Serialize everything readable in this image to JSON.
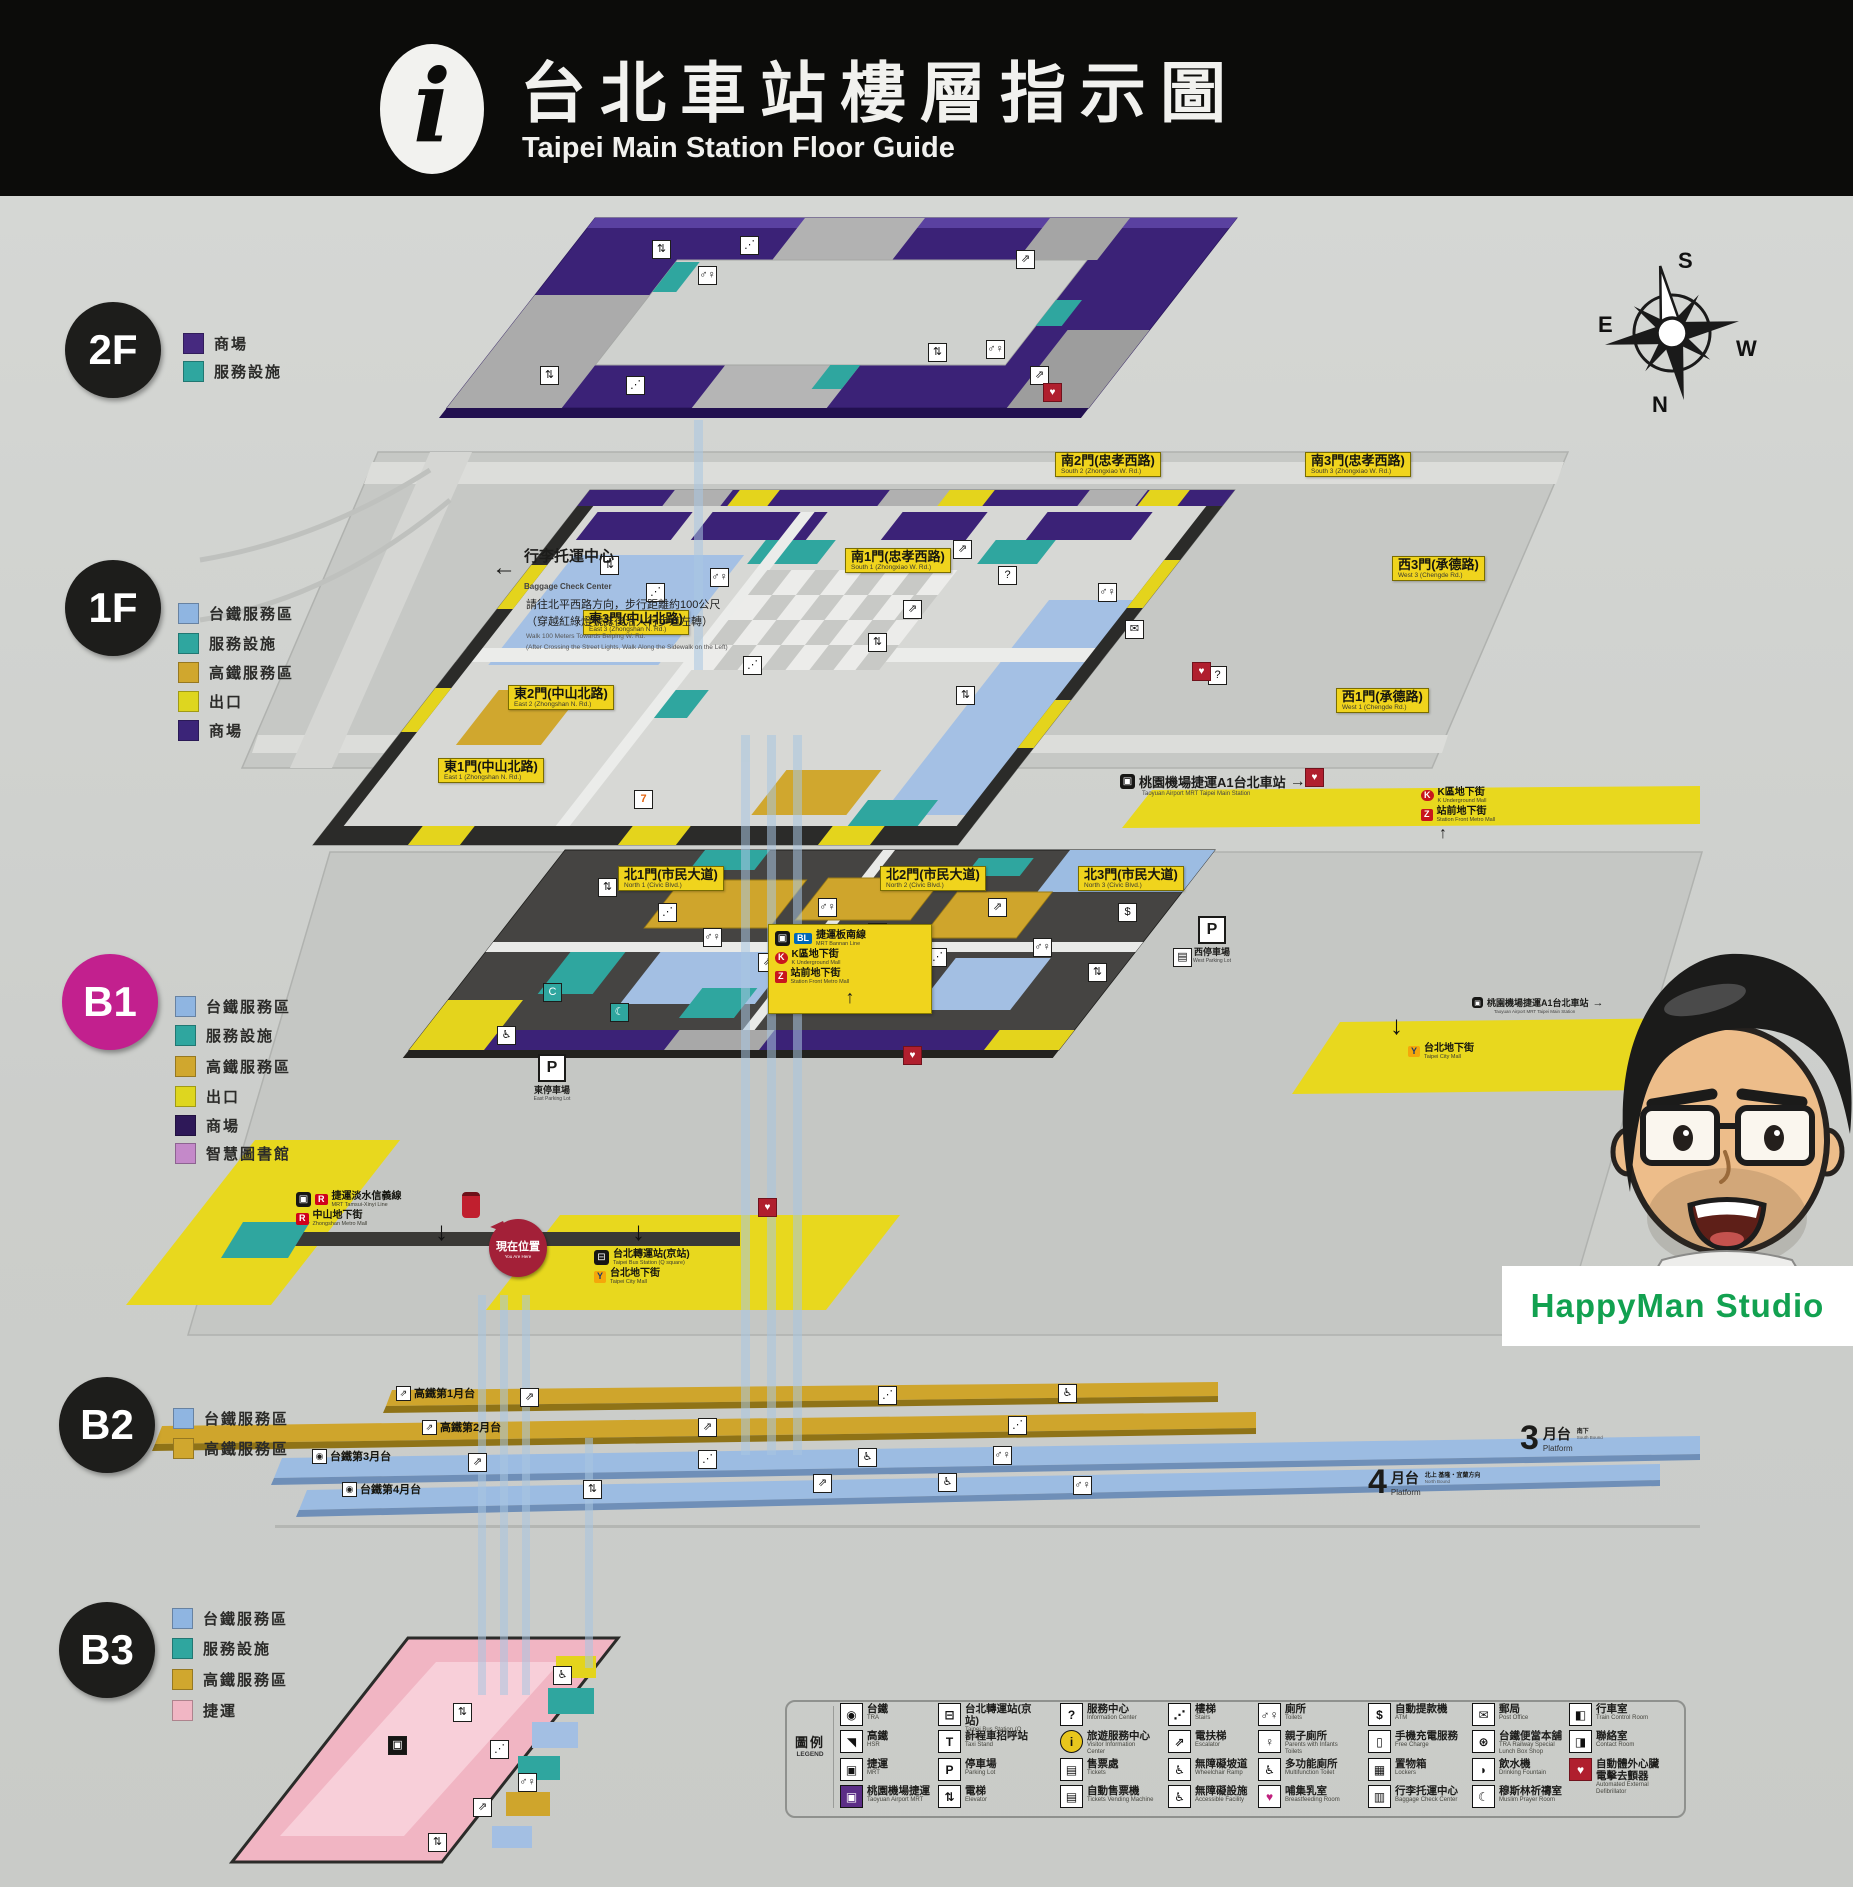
{
  "header": {
    "info_icon": "i",
    "title_cn": "台北車站樓層指示圖",
    "title_en": "Taipei Main Station Floor Guide"
  },
  "compass": {
    "s": "S",
    "e": "E",
    "w": "W",
    "n": "N"
  },
  "colors": {
    "panel_bg": "#d0d2cf",
    "header_bg": "#0c0c0a",
    "mall_purple": "#3b2277",
    "service_teal": "#2fa69f",
    "tra_blue": "#8fb5e1",
    "hsr_mustard": "#d0a72e",
    "exit_yellow": "#f0d41d",
    "library_orchid": "#c489c9",
    "mrt_pink": "#f1b6c4",
    "b1_magenta": "#c2208e",
    "here_red": "#a32038",
    "watermark_green": "#12a150"
  },
  "floor_circles": [
    {
      "label": "2F",
      "x": 113,
      "y": 350,
      "color": "#1d1d1b"
    },
    {
      "label": "1F",
      "x": 113,
      "y": 608,
      "color": "#1d1d1b"
    },
    {
      "label": "B1",
      "x": 110,
      "y": 1002,
      "color": "#c2208e"
    },
    {
      "label": "B2",
      "x": 107,
      "y": 1425,
      "color": "#1d1d1b"
    },
    {
      "label": "B3",
      "x": 107,
      "y": 1650,
      "color": "#1d1d1b"
    }
  ],
  "floor_legends": [
    {
      "x": 183,
      "y": 333,
      "color": "#46297f",
      "label": "商場"
    },
    {
      "x": 183,
      "y": 361,
      "color": "#2fa69f",
      "label": "服務設施"
    },
    {
      "x": 178,
      "y": 603,
      "color": "#8fb5e1",
      "label": "台鐵服務區"
    },
    {
      "x": 178,
      "y": 633,
      "color": "#2fa69f",
      "label": "服務設施"
    },
    {
      "x": 178,
      "y": 662,
      "color": "#d0a72e",
      "label": "高鐵服務區"
    },
    {
      "x": 178,
      "y": 691,
      "color": "#ded61f",
      "label": "出口"
    },
    {
      "x": 178,
      "y": 720,
      "color": "#3b2478",
      "label": "商場"
    },
    {
      "x": 175,
      "y": 996,
      "color": "#8fb5e1",
      "label": "台鐵服務區"
    },
    {
      "x": 175,
      "y": 1025,
      "color": "#2fa69f",
      "label": "服務設施"
    },
    {
      "x": 175,
      "y": 1056,
      "color": "#d0a72e",
      "label": "高鐵服務區"
    },
    {
      "x": 175,
      "y": 1086,
      "color": "#ded61f",
      "label": "出口"
    },
    {
      "x": 175,
      "y": 1115,
      "color": "#2e1858",
      "label": "商場"
    },
    {
      "x": 175,
      "y": 1143,
      "color": "#c489c9",
      "label": "智慧圖書館"
    },
    {
      "x": 173,
      "y": 1408,
      "color": "#8fb5e1",
      "label": "台鐵服務區"
    },
    {
      "x": 173,
      "y": 1438,
      "color": "#d0a72e",
      "label": "高鐵服務區"
    },
    {
      "x": 172,
      "y": 1608,
      "color": "#8fb5e1",
      "label": "台鐵服務區"
    },
    {
      "x": 172,
      "y": 1638,
      "color": "#2fa69f",
      "label": "服務設施"
    },
    {
      "x": 172,
      "y": 1669,
      "color": "#d0a72e",
      "label": "高鐵服務區"
    },
    {
      "x": 172,
      "y": 1700,
      "color": "#f1b6c4",
      "label": "捷運"
    }
  ],
  "gates": [
    {
      "x": 845,
      "y": 548,
      "cn": "南1門(忠孝西路)",
      "en": "South 1 (Zhongxiao W. Rd.)"
    },
    {
      "x": 1055,
      "y": 452,
      "cn": "南2門(忠孝西路)",
      "en": "South 2 (Zhongxiao W. Rd.)"
    },
    {
      "x": 1305,
      "y": 452,
      "cn": "南3門(忠孝西路)",
      "en": "South 3 (Zhongxiao W. Rd.)"
    },
    {
      "x": 583,
      "y": 610,
      "cn": "東3門(中山北路)",
      "en": "East 3 (Zhongshan N. Rd.)"
    },
    {
      "x": 508,
      "y": 685,
      "cn": "東2門(中山北路)",
      "en": "East 2 (Zhongshan N. Rd.)"
    },
    {
      "x": 438,
      "y": 758,
      "cn": "東1門(中山北路)",
      "en": "East 1 (Zhongshan N. Rd.)"
    },
    {
      "x": 1392,
      "y": 556,
      "cn": "西3門(承德路)",
      "en": "West 3 (Chengde Rd.)"
    },
    {
      "x": 1336,
      "y": 688,
      "cn": "西1門(承德路)",
      "en": "West 1 (Chengde Rd.)"
    },
    {
      "x": 618,
      "y": 866,
      "cn": "北1門(市民大道)",
      "en": "North 1 (Civic Blvd.)"
    },
    {
      "x": 880,
      "y": 866,
      "cn": "北2門(市民大道)",
      "en": "North 2 (Civic Blvd.)"
    },
    {
      "x": 1078,
      "y": 866,
      "cn": "北3門(市民大道)",
      "en": "North 3 (Civic Blvd.)"
    }
  ],
  "baggage_note": {
    "arrow": "←",
    "cn": "行李托運中心",
    "en": "Baggage Check Center",
    "body1": "請往北平西路方向，步行距離約100公尺",
    "body2": "（穿越紅綠燈號誌後沿人行步道左轉）",
    "en1": "Walk 100 Meters Towards Beiping W. Rd.",
    "en2": "(After Crossing the Street Lights, Walk Along the Sidewalk on the Left)"
  },
  "a1_sign": {
    "cn": "桃園機場捷運A1台北車站",
    "en": "Taoyuan Airport MRT Taipei Main Station",
    "arrow": "→"
  },
  "b1_badges": {
    "bl": {
      "logo": "BL",
      "cn": "捷運板南線",
      "en": "MRT Bannan Line"
    },
    "k": {
      "logo": "K",
      "cn": "K區地下街",
      "en": "K Underground Mall"
    },
    "z": {
      "logo": "Z",
      "cn": "站前地下街",
      "en": "Station Front Metro Mall"
    },
    "r1": {
      "logo": "R",
      "cn": "捷運淡水信義線",
      "en": "MRT Tamsui-Xinyi Line"
    },
    "r2": {
      "logo": "R",
      "cn": "中山地下街",
      "en": "Zhongshan Metro Mall"
    },
    "bus": {
      "cn": "台北轉運站(京站)",
      "en": "Taipei Bus Station (Q square)"
    },
    "y1": {
      "logo": "Y",
      "cn": "台北地下街",
      "en": "Taipei City Mall"
    },
    "east_p": {
      "logo": "P",
      "cn": "東停車場",
      "en": "East Parking Lot"
    },
    "west_p": {
      "logo": "P",
      "cn": "西停車場",
      "en": "West Parking Lot"
    },
    "here": {
      "cn": "現在位置",
      "en": "You Are Here"
    }
  },
  "plat_labels": [
    {
      "x": 396,
      "y": 1385,
      "ic": "⇗",
      "cn": "高鐵第1月台"
    },
    {
      "x": 422,
      "y": 1419,
      "ic": "⇗",
      "cn": "高鐵第2月台"
    },
    {
      "x": 312,
      "y": 1448,
      "ic": "◉",
      "cn": "台鐵第3月台"
    },
    {
      "x": 342,
      "y": 1481,
      "ic": "◉",
      "cn": "台鐵第4月台"
    }
  ],
  "platforms": {
    "big3": {
      "no": "3",
      "suffix": "月台",
      "en": "Platform",
      "note_cn": "南下",
      "note_en": "South Bound"
    },
    "big4": {
      "no": "4",
      "suffix": "月台",
      "en": "Platform",
      "note_cn": "北上 基隆・宜蘭方向",
      "note_en": "North Bound"
    }
  },
  "icons": {
    "train": "▣",
    "bus": "⊟",
    "arrow_up": "↑",
    "arrow_down": "↓",
    "arrow_right": "→"
  },
  "legend": {
    "title_cn": "圖例",
    "title_en": "LEGEND",
    "items": [
      {
        "x": 840,
        "y": 1703,
        "g": "◉",
        "cn": "台鐵",
        "en": "TRA"
      },
      {
        "x": 840,
        "y": 1730,
        "g": "◥",
        "cn": "高鐵",
        "en": "HSR"
      },
      {
        "x": 840,
        "y": 1758,
        "g": "▣",
        "cn": "捷運",
        "en": "MRT"
      },
      {
        "x": 840,
        "y": 1785,
        "g": "▣",
        "cls": "pur",
        "cn": "桃園機場捷運",
        "en": "Taoyuan Airport MRT"
      },
      {
        "x": 938,
        "y": 1703,
        "g": "⊟",
        "cn": "台北轉運站(京站)",
        "en": "Taipei Bus Station (Q square)"
      },
      {
        "x": 938,
        "y": 1730,
        "g": "T",
        "cn": "計程車招呼站",
        "en": "Taxi Stand"
      },
      {
        "x": 938,
        "y": 1758,
        "g": "P",
        "cn": "停車場",
        "en": "Parking Lot"
      },
      {
        "x": 938,
        "y": 1785,
        "g": "⇅",
        "cn": "電梯",
        "en": "Elevator"
      },
      {
        "x": 1060,
        "y": 1703,
        "g": "?",
        "cn": "服務中心",
        "en": "Information Center"
      },
      {
        "x": 1060,
        "y": 1730,
        "g": "i",
        "cls": "gold",
        "cn": "旅遊服務中心",
        "en": "Visitor Information Center"
      },
      {
        "x": 1060,
        "y": 1758,
        "g": "▤",
        "cn": "售票處",
        "en": "Tickets"
      },
      {
        "x": 1060,
        "y": 1785,
        "g": "▤",
        "cn": "自動售票機",
        "en": "Tickets Vending Machine"
      },
      {
        "x": 1168,
        "y": 1703,
        "g": "⋰",
        "cn": "樓梯",
        "en": "Stairs"
      },
      {
        "x": 1168,
        "y": 1730,
        "g": "⇗",
        "cn": "電扶梯",
        "en": "Escalator"
      },
      {
        "x": 1168,
        "y": 1758,
        "g": "♿",
        "cn": "無障礙坡道",
        "en": "Wheelchair Ramp"
      },
      {
        "x": 1168,
        "y": 1785,
        "g": "♿",
        "cn": "無障礙設施",
        "en": "Accessible Facility"
      },
      {
        "x": 1258,
        "y": 1703,
        "g": "♂♀",
        "cn": "廁所",
        "en": "Toilets"
      },
      {
        "x": 1258,
        "y": 1730,
        "g": "♀",
        "cn": "親子廁所",
        "en": "Parents with Infants Toilets"
      },
      {
        "x": 1258,
        "y": 1758,
        "g": "♿",
        "cn": "多功能廁所",
        "en": "Multifunction Toilet"
      },
      {
        "x": 1258,
        "y": 1785,
        "g": "♥",
        "cls": "mag",
        "cn": "哺集乳室",
        "en": "Breastfeeding Room"
      },
      {
        "x": 1368,
        "y": 1703,
        "g": "$",
        "cn": "自動提款機",
        "en": "ATM"
      },
      {
        "x": 1368,
        "y": 1730,
        "g": "▯",
        "cn": "手機充電服務",
        "en": "Free Charge"
      },
      {
        "x": 1368,
        "y": 1758,
        "g": "▦",
        "cn": "置物箱",
        "en": "Lockers"
      },
      {
        "x": 1368,
        "y": 1785,
        "g": "▥",
        "cn": "行李托運中心",
        "en": "Baggage Check Center"
      },
      {
        "x": 1472,
        "y": 1703,
        "g": "✉",
        "cn": "郵局",
        "en": "Post Office"
      },
      {
        "x": 1472,
        "y": 1730,
        "g": "⊛",
        "cn": "台鐵便當本舖",
        "en": "TRA Railway Special Lunch Box Shop"
      },
      {
        "x": 1472,
        "y": 1758,
        "g": "◗",
        "cn": "飲水機",
        "en": "Drinking Fountain"
      },
      {
        "x": 1472,
        "y": 1785,
        "g": "☾",
        "cn": "穆斯林祈禱室",
        "en": "Muslim Prayer Room"
      },
      {
        "x": 1569,
        "y": 1703,
        "g": "◧",
        "cn": "行車室",
        "en": "Train Control Room"
      },
      {
        "x": 1569,
        "y": 1730,
        "g": "◨",
        "cn": "聯絡室",
        "en": "Contact Room"
      },
      {
        "x": 1569,
        "y": 1758,
        "g": "♥",
        "cls": "aed",
        "cn": "自動體外心臟電擊去顫器",
        "en": "Automated External Defibrillator"
      }
    ]
  },
  "map_icons": [
    {
      "x": 652,
      "y": 240,
      "g": "⇅"
    },
    {
      "x": 740,
      "y": 236,
      "g": "⋰"
    },
    {
      "x": 698,
      "y": 266,
      "g": "♂♀"
    },
    {
      "x": 1016,
      "y": 250,
      "g": "⇗"
    },
    {
      "x": 928,
      "y": 343,
      "g": "⇅"
    },
    {
      "x": 986,
      "y": 340,
      "g": "♂♀"
    },
    {
      "x": 1030,
      "y": 366,
      "g": "⇗"
    },
    {
      "x": 626,
      "y": 376,
      "g": "⋰"
    },
    {
      "x": 540,
      "y": 366,
      "g": "⇅"
    },
    {
      "x": 1043,
      "y": 383,
      "g": "♥",
      "cls": "red"
    },
    {
      "x": 600,
      "y": 556,
      "g": "⇅"
    },
    {
      "x": 646,
      "y": 583,
      "g": "⋰"
    },
    {
      "x": 710,
      "y": 568,
      "g": "♂♀"
    },
    {
      "x": 953,
      "y": 540,
      "g": "⇗"
    },
    {
      "x": 998,
      "y": 566,
      "g": "?"
    },
    {
      "x": 868,
      "y": 633,
      "g": "⇅"
    },
    {
      "x": 1098,
      "y": 583,
      "g": "♂♀"
    },
    {
      "x": 743,
      "y": 656,
      "g": "⋰"
    },
    {
      "x": 903,
      "y": 600,
      "g": "⇗"
    },
    {
      "x": 1208,
      "y": 666,
      "g": "?"
    },
    {
      "x": 1192,
      "y": 662,
      "g": "♥",
      "cls": "red"
    },
    {
      "x": 1305,
      "y": 768,
      "g": "♥",
      "cls": "red"
    },
    {
      "x": 634,
      "y": 790,
      "g": "7",
      "cls": "seven"
    },
    {
      "x": 956,
      "y": 686,
      "g": "⇅"
    },
    {
      "x": 1125,
      "y": 620,
      "g": "✉"
    },
    {
      "x": 598,
      "y": 878,
      "g": "⇅"
    },
    {
      "x": 658,
      "y": 903,
      "g": "⋰"
    },
    {
      "x": 703,
      "y": 928,
      "g": "♂♀"
    },
    {
      "x": 758,
      "y": 953,
      "g": "⇗"
    },
    {
      "x": 818,
      "y": 898,
      "g": "♂♀"
    },
    {
      "x": 868,
      "y": 923,
      "g": "⇅"
    },
    {
      "x": 928,
      "y": 948,
      "g": "⋰"
    },
    {
      "x": 988,
      "y": 898,
      "g": "⇗"
    },
    {
      "x": 1033,
      "y": 938,
      "g": "♂♀"
    },
    {
      "x": 1088,
      "y": 963,
      "g": "⇅"
    },
    {
      "x": 610,
      "y": 1003,
      "g": "☾",
      "cls": "teal"
    },
    {
      "x": 543,
      "y": 983,
      "g": "C",
      "cls": "teal"
    },
    {
      "x": 758,
      "y": 1198,
      "g": "♥",
      "cls": "red"
    },
    {
      "x": 903,
      "y": 1046,
      "g": "♥",
      "cls": "red"
    },
    {
      "x": 1118,
      "y": 903,
      "g": "$"
    },
    {
      "x": 1173,
      "y": 948,
      "g": "▤"
    },
    {
      "x": 497,
      "y": 1026,
      "g": "♿"
    },
    {
      "x": 520,
      "y": 1388,
      "g": "⇗"
    },
    {
      "x": 878,
      "y": 1386,
      "g": "⋰"
    },
    {
      "x": 1058,
      "y": 1384,
      "g": "♿"
    },
    {
      "x": 698,
      "y": 1418,
      "g": "⇗"
    },
    {
      "x": 1008,
      "y": 1416,
      "g": "⋰"
    },
    {
      "x": 468,
      "y": 1453,
      "g": "⇗"
    },
    {
      "x": 698,
      "y": 1450,
      "g": "⋰"
    },
    {
      "x": 858,
      "y": 1448,
      "g": "♿"
    },
    {
      "x": 993,
      "y": 1446,
      "g": "♂♀"
    },
    {
      "x": 1073,
      "y": 1476,
      "g": "♂♀"
    },
    {
      "x": 938,
      "y": 1473,
      "g": "♿"
    },
    {
      "x": 813,
      "y": 1474,
      "g": "⇗"
    },
    {
      "x": 583,
      "y": 1480,
      "g": "⇅"
    },
    {
      "x": 453,
      "y": 1703,
      "g": "⇅"
    },
    {
      "x": 490,
      "y": 1740,
      "g": "⋰"
    },
    {
      "x": 518,
      "y": 1773,
      "g": "♂♀"
    },
    {
      "x": 473,
      "y": 1798,
      "g": "⇗"
    },
    {
      "x": 428,
      "y": 1833,
      "g": "⇅"
    },
    {
      "x": 553,
      "y": 1666,
      "g": "♿"
    },
    {
      "x": 388,
      "y": 1736,
      "g": "▣",
      "cls": "blk"
    }
  ],
  "arrows": [
    {
      "x": 435,
      "y": 1216,
      "g": "↓"
    },
    {
      "x": 632,
      "y": 1216,
      "g": "↓"
    },
    {
      "x": 1390,
      "y": 1010,
      "g": "↓"
    }
  ],
  "watermark": {
    "text": "HappyMan Studio"
  }
}
